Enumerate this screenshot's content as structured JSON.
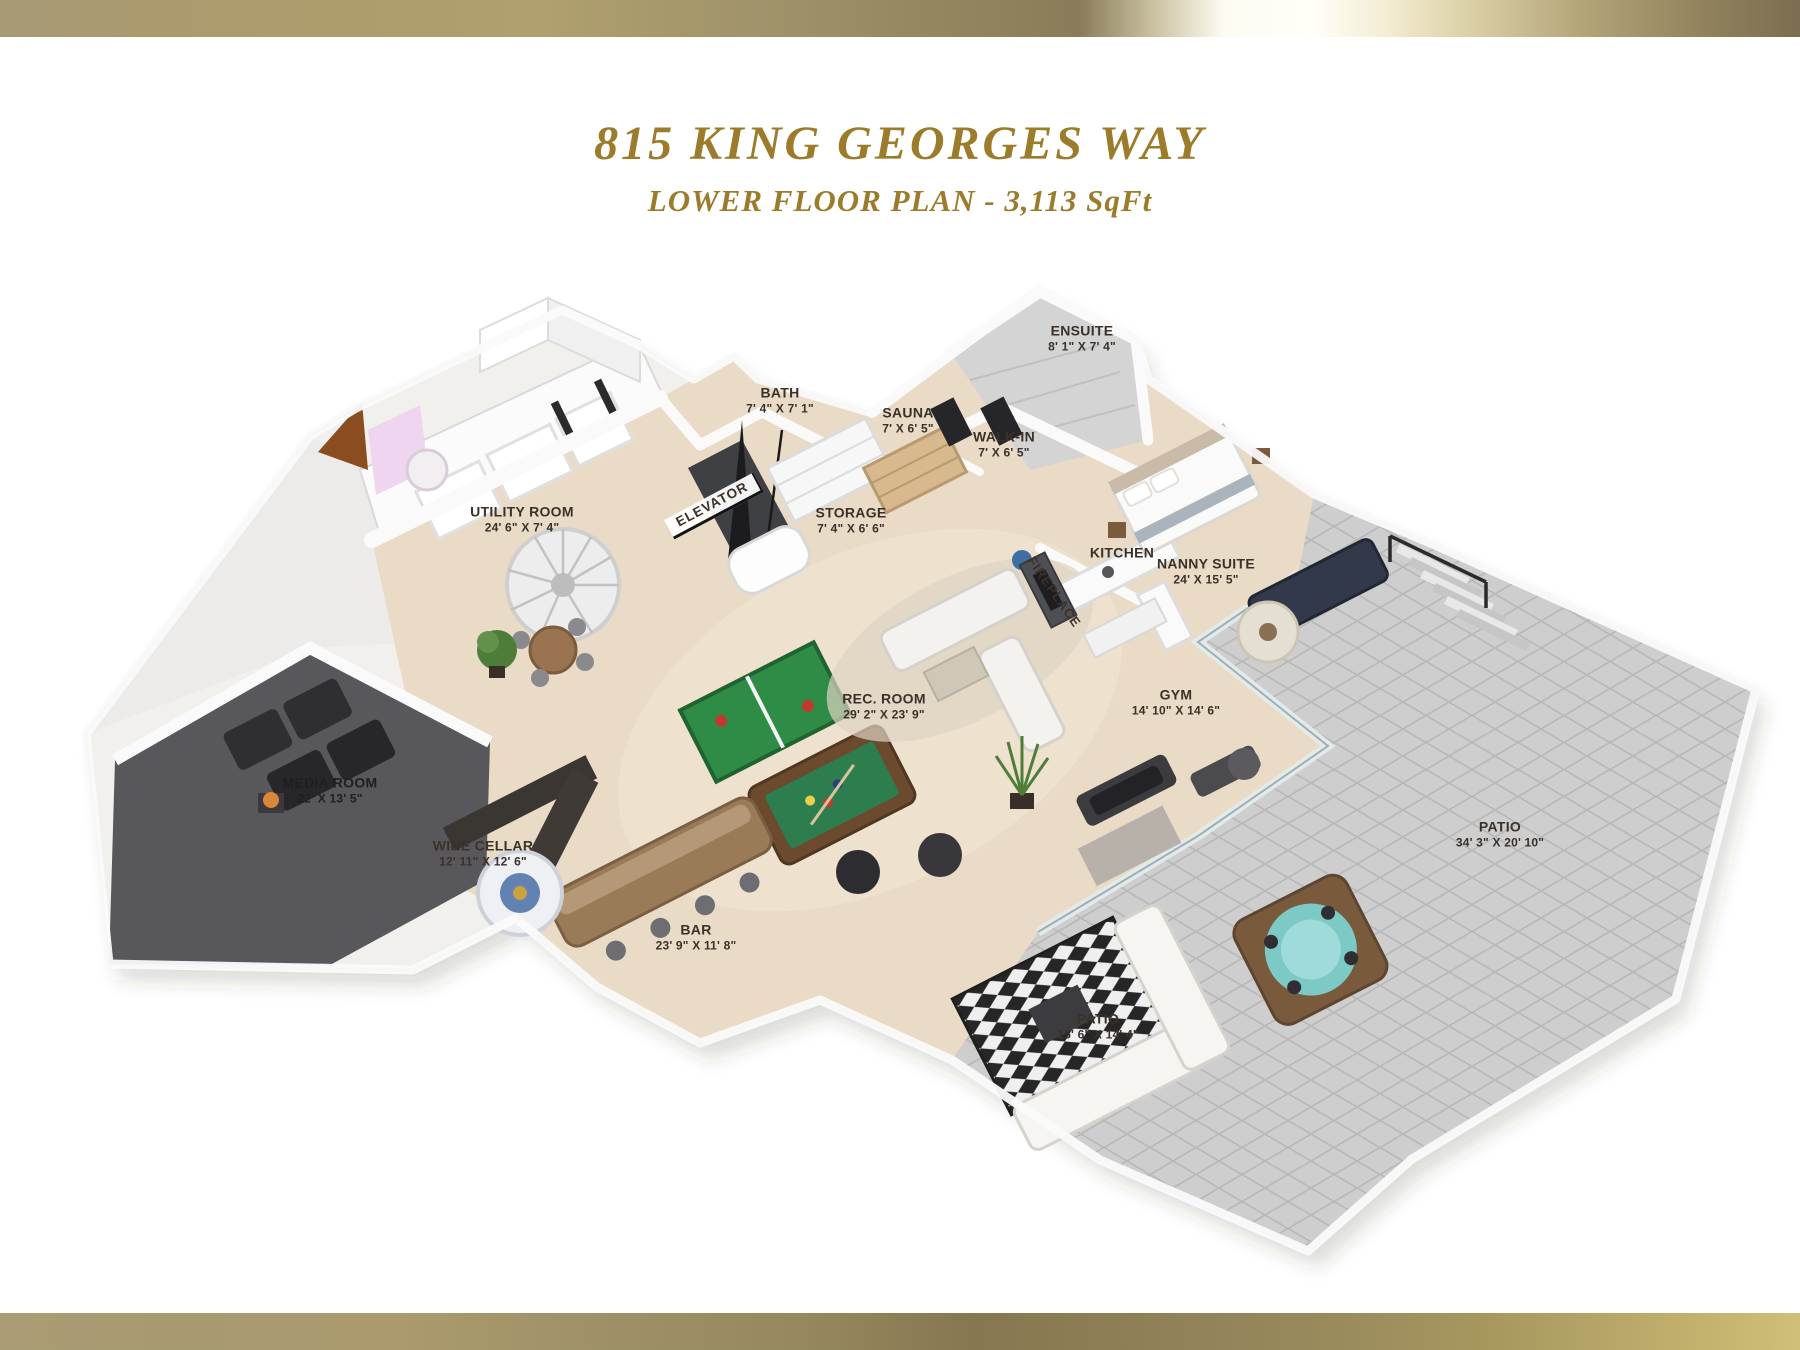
{
  "page": {
    "title": "815 KING GEORGES WAY",
    "subtitle": "LOWER FLOOR PLAN - 3,113 SqFt"
  },
  "palette": {
    "accent_gold": "#9c7b2a",
    "banner_gold_light": "#fffef8",
    "banner_gold_dark": "#7b6d4f",
    "floor_beige": "#e9dbc6",
    "left_wing_floor": "#edebe9",
    "patio_gray": "#cecece",
    "patio_grout": "#b5b5b5",
    "media_room_floor": "#58585c",
    "wall_white": "#fafafa",
    "pool_table_green": "#2e7d4f",
    "ping_pong_green": "#2f8c46",
    "hot_tub_teal": "#7cc9c6",
    "bar_wood": "#9a7b57",
    "label_text": "#3a3129"
  },
  "rooms": [
    {
      "name": "BATH",
      "dims": "7' 4\" X 7' 1\""
    },
    {
      "name": "ENSUITE",
      "dims": "8' 1\" X 7' 4\""
    },
    {
      "name": "SAUNA",
      "dims": "7' X 6' 5\""
    },
    {
      "name": "WALK-IN",
      "dims": "7' X 6' 5\""
    },
    {
      "name": "STORAGE",
      "dims": "7' 4\" X 6' 6\""
    },
    {
      "name": "ELEVATOR",
      "dims": ""
    },
    {
      "name": "UTILITY ROOM",
      "dims": "24' 6\" X 7' 4\""
    },
    {
      "name": "KITCHEN",
      "dims": ""
    },
    {
      "name": "NANNY SUITE",
      "dims": "24' X 15' 5\""
    },
    {
      "name": "FIREPLACE",
      "dims": ""
    },
    {
      "name": "REC. ROOM",
      "dims": "29' 2\" X 23' 9\""
    },
    {
      "name": "GYM",
      "dims": "14' 10\" X 14' 6\""
    },
    {
      "name": "MEDIA ROOM",
      "dims": "22' X 13' 5\""
    },
    {
      "name": "WINE CELLAR",
      "dims": "12' 11\" X 12' 6\""
    },
    {
      "name": "BAR",
      "dims": "23' 9\" X 11' 8\""
    },
    {
      "name": "PATIO",
      "dims": "15' 6\" X 14' 4\""
    },
    {
      "name": "PATIO",
      "dims": "34' 3\" X 20' 10\""
    }
  ]
}
